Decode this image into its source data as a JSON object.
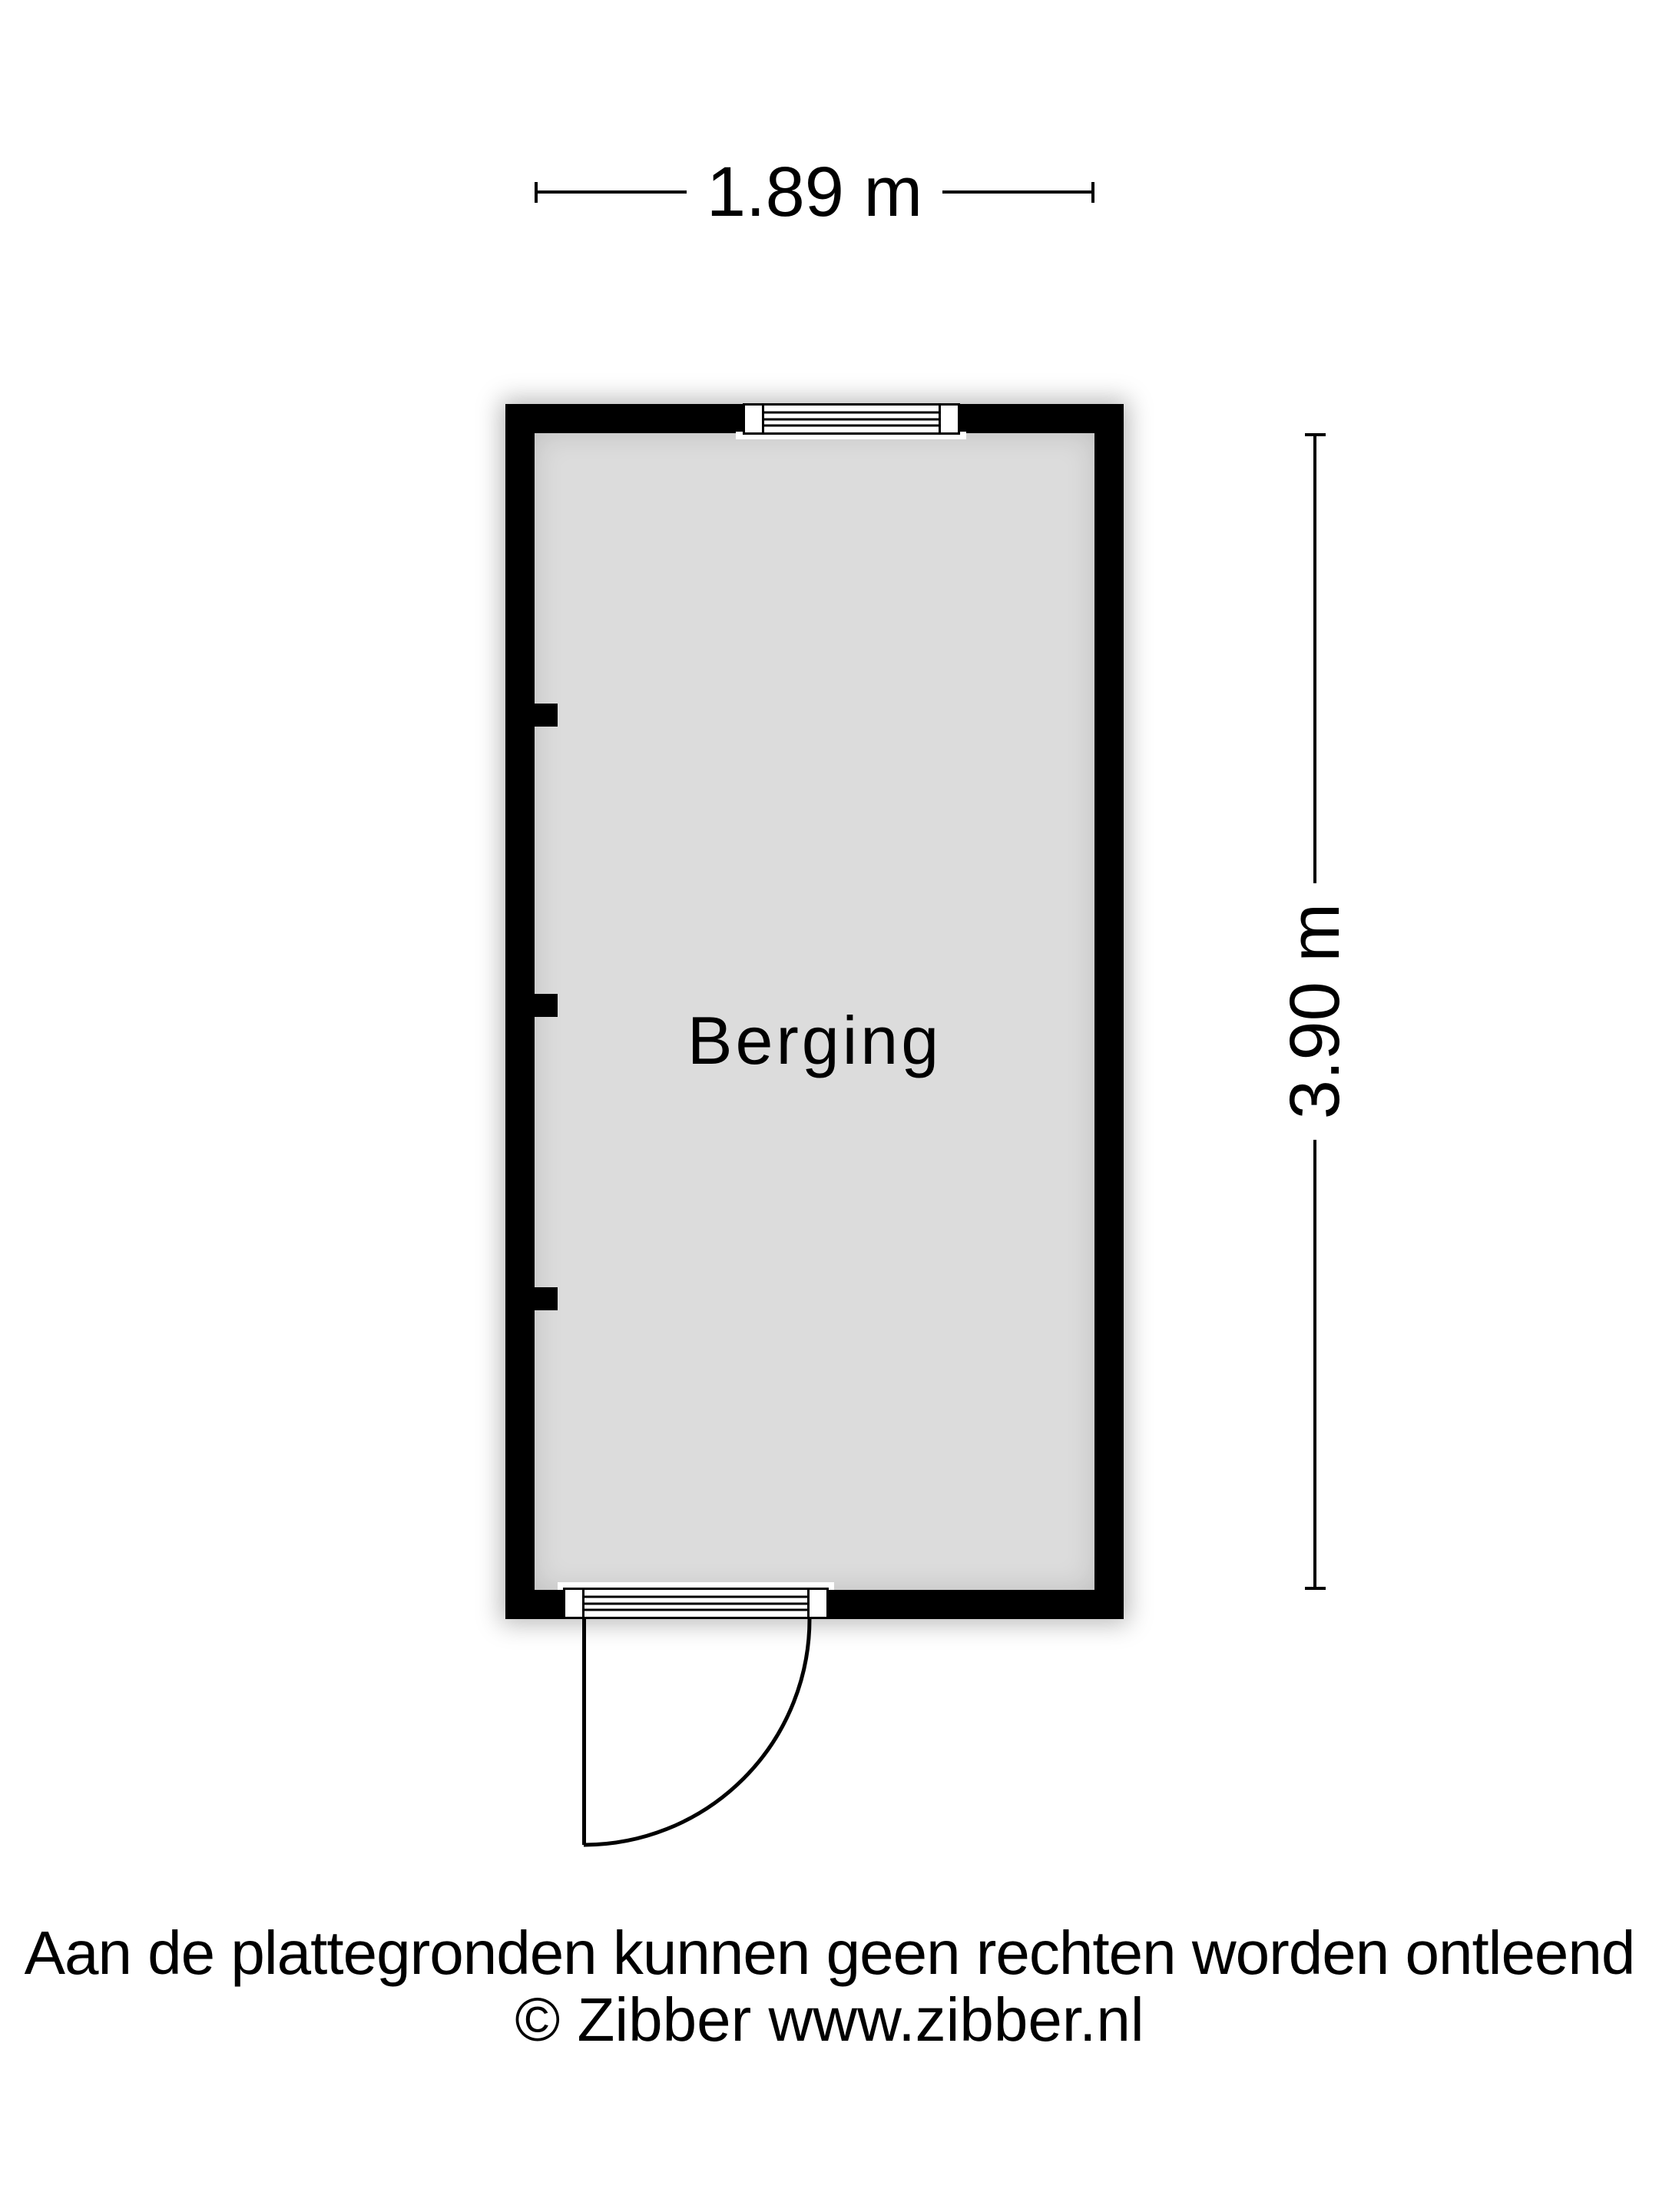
{
  "floorplan": {
    "room_label": "Berging",
    "width_dimension": "1.89 m",
    "height_dimension": "3.90 m"
  },
  "footer": {
    "disclaimer": "Aan de plattegronden kunnen geen rechten worden ontleend",
    "copyright": "© Zibber www.zibber.nl"
  },
  "colors": {
    "background": "#ffffff",
    "wall": "#000000",
    "floor": "#dcdcdc",
    "text": "#000000"
  }
}
